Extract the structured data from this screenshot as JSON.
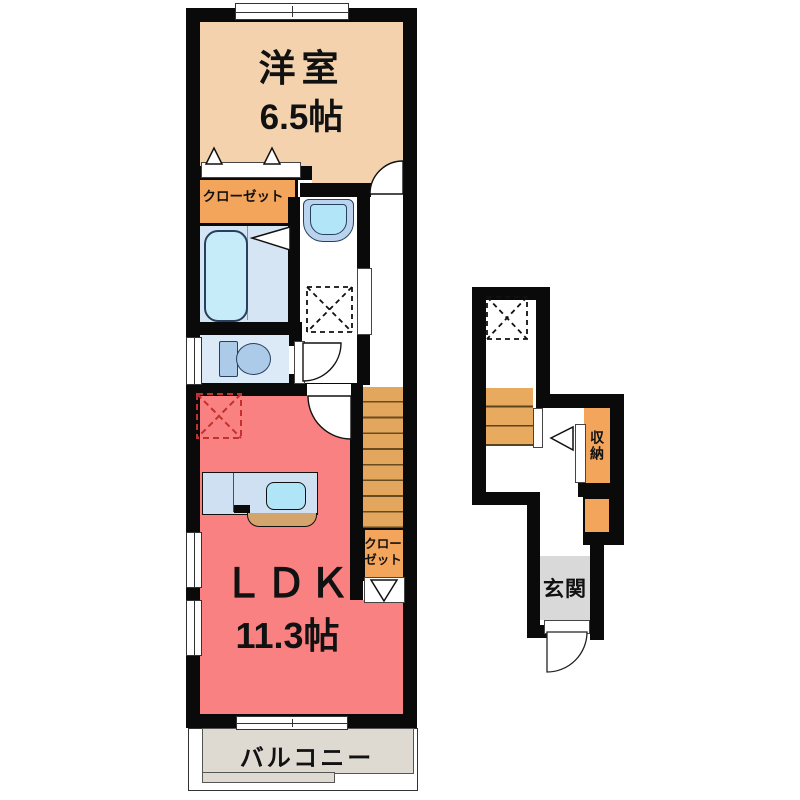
{
  "colors": {
    "wall": "#0a0a0a",
    "bedroom": "#f3d2ad",
    "closet_orange": "#f2a55b",
    "stairs": "#e2a65c",
    "ldk": "#f98181",
    "bath_floor": "#d6e5f4",
    "bathtub": "#c6ebf9",
    "fixture_blue": "#abcbe9",
    "toilet_floor": "#dceaf8",
    "kitchen_counter": "#cfe0f3",
    "kitchen_sink": "#b0e5f7",
    "kitchen_front": "#d3a46b",
    "balcony": "#dedad2",
    "entrance": "#d9d9d9",
    "fridge_dash": "#c23030"
  },
  "main_floor": {
    "bedroom": {
      "label": "洋室",
      "size": "6.5帖"
    },
    "bedroom_closet": {
      "label": "クローゼット"
    },
    "ldk": {
      "label": "ＬＤＫ",
      "size": "11.3帖"
    },
    "stair_closet": {
      "line1": "クロー",
      "line2": "ゼット"
    },
    "balcony": {
      "label": "バルコニー"
    }
  },
  "entrance_floor": {
    "storage": {
      "label": "収納"
    },
    "entrance": {
      "label": "玄関"
    }
  }
}
